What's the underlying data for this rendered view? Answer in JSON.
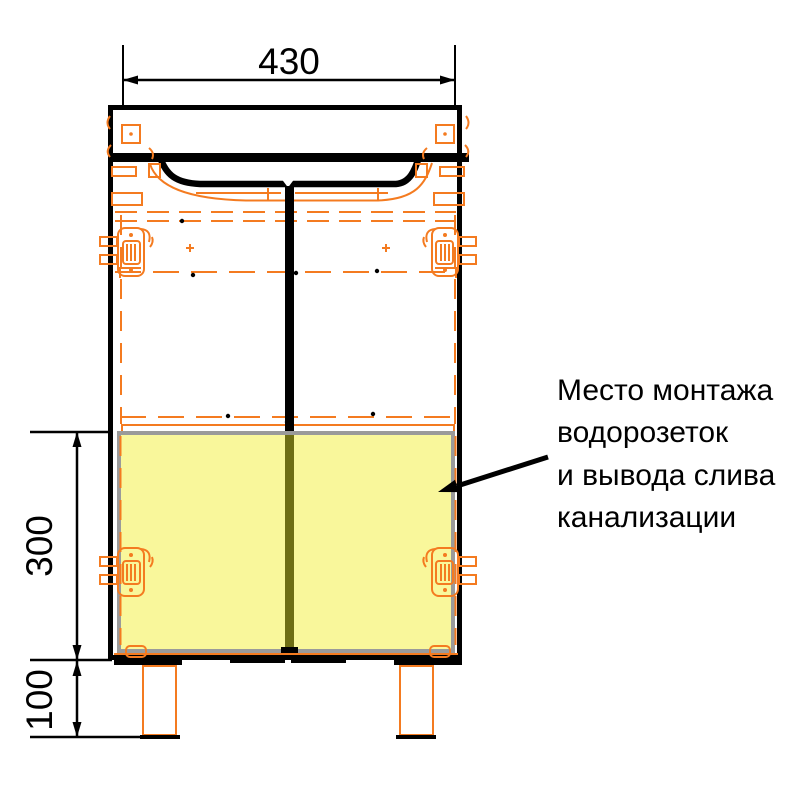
{
  "drawing": {
    "kind": "furniture installation diagram",
    "dimensions": {
      "width_top": {
        "value": "430"
      },
      "zone_height": {
        "value": "300"
      },
      "leg_height": {
        "value": "100"
      }
    },
    "annotation": {
      "lines": [
        "Место монтажа",
        "водорозеток",
        "и вывода слива",
        "канализации"
      ]
    }
  },
  "colors": {
    "outline": "#000000",
    "hardware": "#F47B20",
    "highlight_fill": "#F9F79B",
    "highlight_border": "#9A9A9A",
    "divider_on_highlight": "#6E6E14"
  }
}
